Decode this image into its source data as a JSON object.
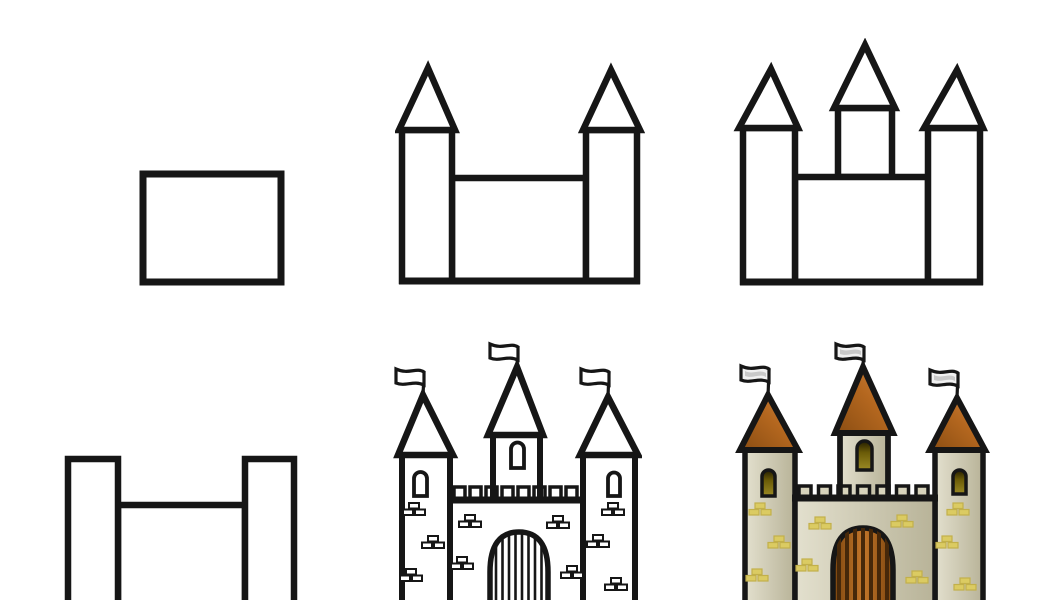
{
  "canvas": {
    "width": 600,
    "height": 600,
    "background": "#ffffff"
  },
  "tutorial": {
    "subject": "how-to-draw-a-castle",
    "grid": "2x3",
    "steps": [
      {
        "position": "top-left",
        "name": "base-rectangle"
      },
      {
        "position": "top-middle",
        "name": "two-side-towers-with-cone-roofs"
      },
      {
        "position": "top-right",
        "name": "three-towers-with-cone-roofs"
      },
      {
        "position": "bottom-left",
        "name": "two-side-towers-no-roofs"
      },
      {
        "position": "bottom-middle",
        "name": "detailed-castle-outline-flags-door-windows-battlements"
      },
      {
        "position": "bottom-right",
        "name": "finished-colored-castle"
      }
    ]
  },
  "colors": {
    "background": "#ffffff",
    "line": "#161616",
    "roof_dark": "#8a4d12",
    "roof_mid": "#b4671f",
    "roof_light": "#ce8340",
    "wall_light": "#e3e0ce",
    "wall_dark": "#b8b398",
    "merlon_fill": "#d7d3bb",
    "window_top": "#231c00",
    "window_mid": "#6b5c08",
    "window_bottom": "#9c8b25",
    "door_edge": "#7c450e",
    "door_center": "#c3762a",
    "door_gap": "#46280a",
    "flag_fill": "#f0f0f0",
    "flag_shade": "#c9c9c9",
    "brick_fill": "#dbcb62",
    "brick_edge": "#c2b04a"
  }
}
